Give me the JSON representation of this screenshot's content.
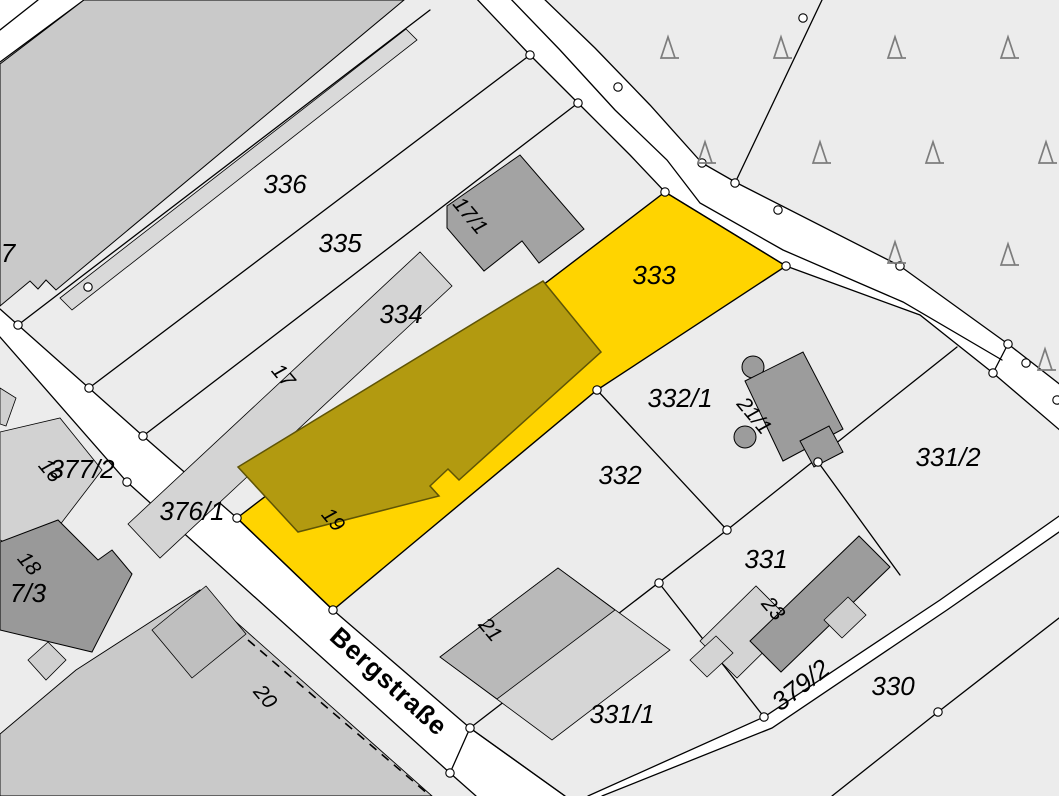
{
  "map": {
    "type": "cadastral-parcel-map",
    "street_name": "Bergstraße",
    "highlighted_parcel": "333",
    "selected_building_house_number": "19",
    "colors": {
      "background_parcel": "#ececec",
      "road": "#ffffff",
      "boundary_line": "#000000",
      "highlight_parcel_fill": "#ffd400",
      "selected_building_fill": "#b29a10",
      "building_light": "#d6d6d6",
      "building_medium": "#c9c9c9",
      "building_dark": "#9c9c9c",
      "tree_symbol": "#7d7d7d",
      "vertex_point_fill": "#ffffff"
    },
    "street_label": {
      "text": "Bergstraße",
      "x": 383,
      "y": 688,
      "rot": 42
    },
    "parcel_labels": [
      {
        "text": "336",
        "x": 285,
        "y": 193,
        "rot": 0
      },
      {
        "text": "335",
        "x": 340,
        "y": 252,
        "rot": 0
      },
      {
        "text": "334",
        "x": 401,
        "y": 323,
        "rot": 0
      },
      {
        "text": "333",
        "x": 654,
        "y": 284,
        "rot": 0
      },
      {
        "text": "332/1",
        "x": 680,
        "y": 407,
        "rot": 0
      },
      {
        "text": "332",
        "x": 620,
        "y": 484,
        "rot": 0
      },
      {
        "text": "331/2",
        "x": 948,
        "y": 466,
        "rot": 0
      },
      {
        "text": "331",
        "x": 766,
        "y": 568,
        "rot": 0
      },
      {
        "text": "330",
        "x": 893,
        "y": 695,
        "rot": 0
      },
      {
        "text": "331/1",
        "x": 622,
        "y": 723,
        "rot": 0
      },
      {
        "text": "377/2",
        "x": 82,
        "y": 478,
        "rot": 0
      },
      {
        "text": "376/1",
        "x": 192,
        "y": 520,
        "rot": 0
      },
      {
        "text": "379/2",
        "x": 806,
        "y": 692,
        "rot": -38
      },
      {
        "text": "7",
        "x": 8,
        "y": 262,
        "rot": 0
      },
      {
        "text": "7/3",
        "x": 28,
        "y": 602,
        "rot": 0
      }
    ],
    "house_numbers": [
      {
        "text": "17",
        "x": 278,
        "y": 380,
        "rot": 50
      },
      {
        "text": "19",
        "x": 328,
        "y": 524,
        "rot": 50
      },
      {
        "text": "20",
        "x": 260,
        "y": 701,
        "rot": 50
      },
      {
        "text": "21",
        "x": 485,
        "y": 634,
        "rot": 50
      },
      {
        "text": "23",
        "x": 768,
        "y": 613,
        "rot": 50
      },
      {
        "text": "16",
        "x": 45,
        "y": 475,
        "rot": 50
      },
      {
        "text": "18",
        "x": 24,
        "y": 568,
        "rot": 50
      },
      {
        "text": "21/1",
        "x": 749,
        "y": 420,
        "rot": 50
      },
      {
        "text": "17/1",
        "x": 465,
        "y": 220,
        "rot": 50
      }
    ],
    "trees": [
      [
        668,
        48
      ],
      [
        781,
        48
      ],
      [
        895,
        48
      ],
      [
        1008,
        48
      ],
      [
        705,
        153
      ],
      [
        820,
        153
      ],
      [
        933,
        153
      ],
      [
        1046,
        153
      ],
      [
        895,
        253
      ],
      [
        1008,
        255
      ],
      [
        1045,
        360
      ]
    ],
    "boundary_points": [
      [
        803,
        18
      ],
      [
        618,
        87
      ],
      [
        530,
        55
      ],
      [
        578,
        103
      ],
      [
        702,
        163
      ],
      [
        735,
        183
      ],
      [
        778,
        210
      ],
      [
        665,
        192
      ],
      [
        786,
        266
      ],
      [
        900,
        266
      ],
      [
        1008,
        344
      ],
      [
        1026,
        363
      ],
      [
        993,
        373
      ],
      [
        1057,
        400
      ],
      [
        597,
        390
      ],
      [
        18,
        325
      ],
      [
        88,
        287
      ],
      [
        89,
        388
      ],
      [
        143,
        436
      ],
      [
        237,
        518
      ],
      [
        127,
        482
      ],
      [
        333,
        610
      ],
      [
        470,
        728
      ],
      [
        450,
        773
      ],
      [
        727,
        530
      ],
      [
        818,
        462
      ],
      [
        659,
        583
      ],
      [
        764,
        717
      ],
      [
        938,
        712
      ]
    ]
  }
}
